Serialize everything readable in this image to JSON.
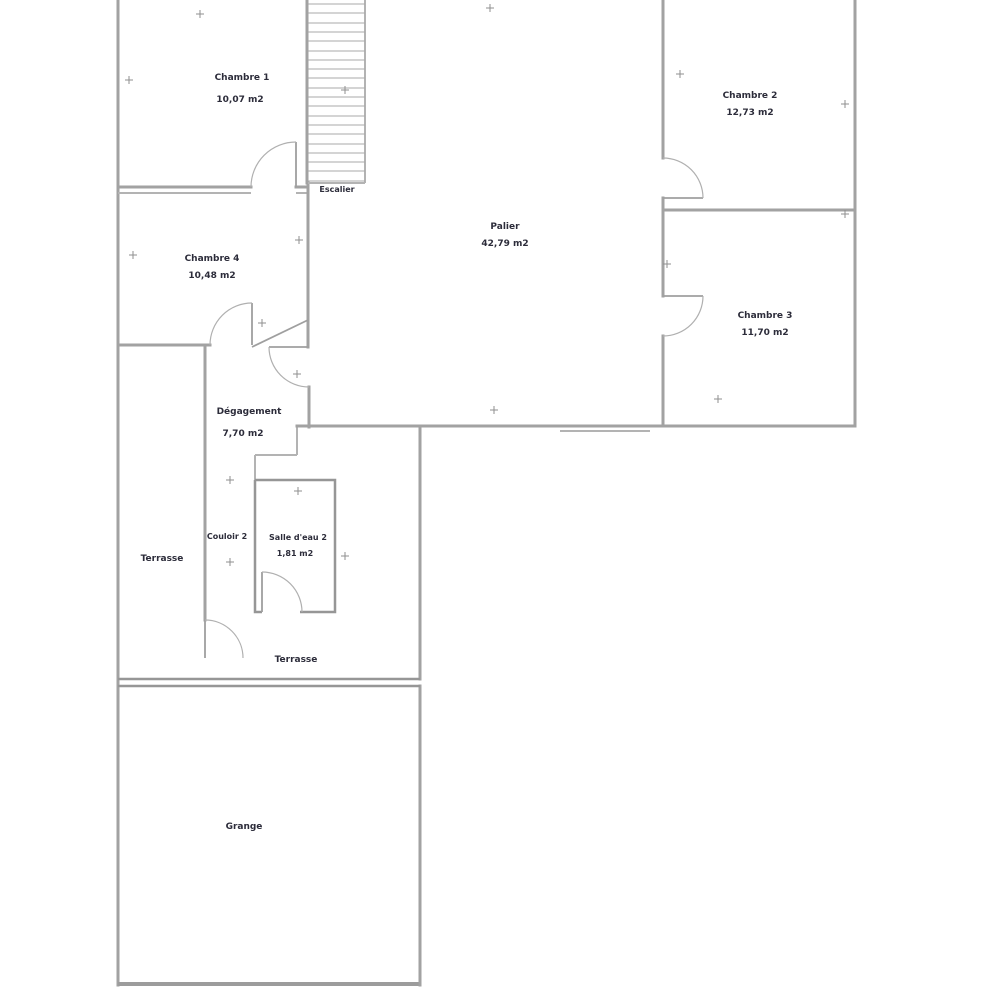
{
  "title": "Plan d'étage",
  "colors": {
    "background": "#ffffff",
    "wall": "#a2a2a2",
    "text": "#2c2c3a"
  },
  "rooms": {
    "chambre1": {
      "name": "Chambre 1",
      "area": "10,07 m2"
    },
    "chambre2": {
      "name": "Chambre 2",
      "area": "12,73 m2"
    },
    "chambre3": {
      "name": "Chambre 3",
      "area": "11,70 m2"
    },
    "chambre4": {
      "name": "Chambre 4",
      "area": "10,48 m2"
    },
    "palier": {
      "name": "Palier",
      "area": "42,79 m2"
    },
    "degagement": {
      "name": "Dégagement",
      "area": "7,70 m2"
    },
    "couloir": {
      "name": "Couloir 2"
    },
    "salle_eau": {
      "name": "Salle d'eau 2",
      "area": "1,81 m2"
    },
    "terrasse1": {
      "name": "Terrasse"
    },
    "terrasse2": {
      "name": "Terrasse"
    },
    "grange": {
      "name": "Grange"
    },
    "escalier": {
      "name": "Escalier"
    }
  }
}
